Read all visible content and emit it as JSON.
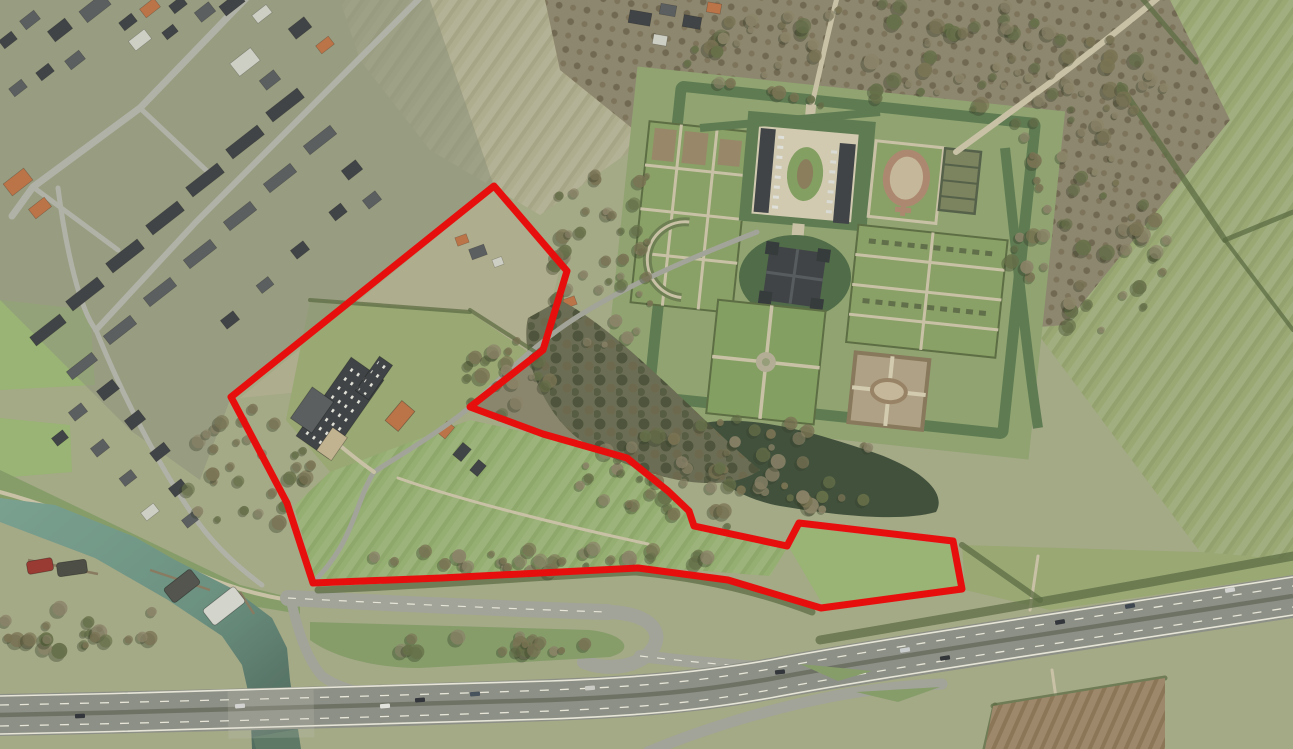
{
  "meta": {
    "description": "Aerial orthophoto with red cadastral parcel boundary overlay",
    "width_px": 1293,
    "height_px": 749
  },
  "palette": {
    "field_base": "#a7ac8a",
    "field_pale": "#b2b091",
    "field_mid": "#9cab77",
    "field_green": "#97b173",
    "field_bright": "#9bb877",
    "dike_green": "#87a06c",
    "town_base": "#90957f",
    "scrub": "#8c8770",
    "park": "#8f8871",
    "street": "#b4b6ac",
    "road": "#a5a79d",
    "path": "#cdc6ab",
    "gravel": "#d6cfb6",
    "highway": "#8f9289",
    "highway_median": "#6e7267",
    "lane_mark": "#edebe0",
    "river_light": "#7ba394",
    "river_deep": "#4b655a",
    "canal": "#5d7a68",
    "moat": "#5e7c53",
    "moat_dark": "#506c48",
    "pond": "#40503c",
    "woods": "#6b6e55",
    "wood_dark": "#3f4c36",
    "tree_a": "#7b7455",
    "tree_b": "#8d856b",
    "tree_c": "#667049",
    "hedge": "#5c6e44",
    "lawn": "#8ba368",
    "garden_lawn": "#84a263",
    "parterre": "#9a8a6b",
    "knot_ring": "#b08a73",
    "plow": "#a08a6d",
    "roof_dark": "#3e4246",
    "roof_slate": "#5a5e61",
    "roof_orange": "#bf7348",
    "roof_light": "#d3d4cb",
    "roof_tan": "#c7b794",
    "parcel_red": "#ee0a0a"
  },
  "landmarks": {
    "town": "residential village north-west",
    "estate": "moated castle estate with formal gardens",
    "river": "river harbour with moored barges",
    "motorway": "motorway with interchange ramps",
    "parcel": "red outlined land parcel"
  },
  "parcel": {
    "name": "highlighted-parcel-boundary",
    "stroke_width": 7,
    "points": "494,186 567,271 543,350 470,407 543,434 627,458 668,491 689,511 694,526 787,546 799,523 953,541 962,589 821,608 728,580 638,568 441,578 313,583 287,503 231,397"
  },
  "roads": [
    {
      "name": "main-street",
      "d": "M250,-6 L140,108 L33,187 L12,216",
      "w": 7,
      "c": "street"
    },
    {
      "name": "back-street",
      "d": "M424,-6 L310,108 L196,222 L96,330",
      "w": 6,
      "c": "street"
    },
    {
      "name": "cross-street-1",
      "d": "M140,108 L208,172",
      "w": 5,
      "c": "street"
    },
    {
      "name": "cross-street-2",
      "d": "M33,187 L118,250",
      "w": 5,
      "c": "street"
    },
    {
      "name": "south-street",
      "d": "M58,188 C66,250 80,310 96,330",
      "w": 5,
      "c": "street"
    },
    {
      "name": "harbour-lane",
      "d": "M96,330 C120,390 160,470 200,525 C215,545 235,565 262,585",
      "w": 5,
      "c": "street"
    },
    {
      "name": "dike-path",
      "d": "M0,492 C60,508 120,535 168,560 C205,578 240,592 288,600",
      "w": 4,
      "c": "path"
    },
    {
      "name": "castle-lane",
      "d": "M757,232 C690,258 610,292 558,330 C520,358 495,384 470,407 C440,432 400,455 374,472 C362,490 356,520 340,548 C330,565 320,575 313,583",
      "w": 5,
      "c": "road"
    },
    {
      "name": "farm-drive",
      "d": "M374,472 C360,462 350,454 338,444",
      "w": 4,
      "c": "path"
    },
    {
      "name": "field-track",
      "d": "M398,478 C460,500 560,525 648,544",
      "w": 3,
      "c": "path"
    },
    {
      "name": "north-avenue-drive",
      "d": "M812,104 C818,80 826,40 838,-6",
      "w": 5,
      "c": "path"
    },
    {
      "name": "ne-tree-lane",
      "d": "M956,152 C1020,105 1090,55 1165,-8",
      "w": 6,
      "c": "path"
    },
    {
      "name": "underpass-track-n",
      "d": "M1038,556 L1030,610",
      "w": 3,
      "c": "path"
    },
    {
      "name": "underpass-track-s",
      "d": "M1052,670 L1060,726",
      "w": 3,
      "c": "path"
    },
    {
      "name": "local-road",
      "d": "M288,598 C400,604 540,610 608,612",
      "w": 16,
      "c": "road"
    },
    {
      "name": "ramp-loop",
      "d": "M608,612 C652,613 666,634 650,652 C635,669 604,670 584,662",
      "w": 14,
      "c": "road"
    },
    {
      "name": "ramp-merge",
      "d": "M640,656 C700,663 750,667 800,670 L872,677",
      "w": 12,
      "c": "road"
    },
    {
      "name": "west-onramp",
      "d": "M291,601 C298,630 306,658 322,676 C340,690 372,697 424,700",
      "w": 10,
      "c": "road"
    },
    {
      "name": "south-ramp",
      "d": "M648,752 C700,730 770,708 840,695 C880,688 912,685 942,684",
      "w": 11,
      "c": "road"
    }
  ],
  "road_marks": [
    {
      "name": "local-road-centerline",
      "d": "M288,598 C400,604 540,610 608,612",
      "w": 1.2,
      "dash": "8 9"
    },
    {
      "name": "ramp-centerline",
      "d": "M640,656 C700,663 750,667 800,670",
      "w": 1.2,
      "dash": "8 9"
    }
  ],
  "hedges": [
    {
      "name": "hedge-ne-1",
      "d": "M1120,85 L1225,240",
      "w": 6
    },
    {
      "name": "hedge-ne-2",
      "d": "M1225,240 L1293,212",
      "w": 5
    },
    {
      "name": "hedge-ne-3",
      "d": "M1140,-4 L1196,62",
      "w": 5
    },
    {
      "name": "hedge-ne-4",
      "d": "M1225,240 L1293,330",
      "w": 4
    },
    {
      "name": "hedge-motorway",
      "d": "M820,640 C950,618 1100,592 1293,556",
      "w": 9
    },
    {
      "name": "hedge-parcel-south",
      "d": "M318,590 C450,585 560,575 636,572 C700,578 760,592 812,612",
      "w": 7
    },
    {
      "name": "hedge-east-field",
      "d": "M962,545 L1040,600",
      "w": 6
    },
    {
      "name": "hedge-plow-top",
      "d": "M993,706 L1165,678",
      "w": 5
    },
    {
      "name": "hedge-plow-left",
      "d": "M995,705 L985,749",
      "w": 5
    },
    {
      "name": "hedge-mid-1",
      "d": "M470,310 L540,355",
      "w": 4
    },
    {
      "name": "hedge-mid-2",
      "d": "M310,300 L470,312",
      "w": 4
    }
  ],
  "houses": [
    [
      95,
      8,
      30,
      14,
      -38,
      "roof_slate"
    ],
    [
      128,
      22,
      16,
      10,
      -38,
      "roof_dark"
    ],
    [
      150,
      8,
      18,
      11,
      -38,
      "roof_orange"
    ],
    [
      178,
      5,
      16,
      10,
      -38,
      "roof_dark"
    ],
    [
      205,
      12,
      18,
      12,
      -38,
      "roof_slate"
    ],
    [
      232,
      4,
      24,
      12,
      -38,
      "roof_dark"
    ],
    [
      262,
      14,
      18,
      10,
      -38,
      "roof_light"
    ],
    [
      300,
      28,
      20,
      13,
      -38,
      "roof_dark"
    ],
    [
      325,
      45,
      16,
      10,
      -38,
      "roof_orange"
    ],
    [
      140,
      40,
      20,
      12,
      -38,
      "roof_light"
    ],
    [
      170,
      32,
      14,
      9,
      -38,
      "roof_dark"
    ],
    [
      245,
      62,
      26,
      16,
      -38,
      "roof_light"
    ],
    [
      270,
      80,
      18,
      12,
      -38,
      "roof_slate"
    ],
    [
      60,
      30,
      22,
      13,
      -38,
      "roof_dark"
    ],
    [
      30,
      20,
      18,
      11,
      -38,
      "roof_slate"
    ],
    [
      8,
      40,
      16,
      10,
      -38,
      "roof_dark"
    ],
    [
      75,
      60,
      18,
      11,
      -38,
      "roof_slate"
    ],
    [
      45,
      72,
      16,
      10,
      -38,
      "roof_dark"
    ],
    [
      18,
      88,
      16,
      10,
      -38,
      "roof_slate"
    ],
    [
      285,
      105,
      40,
      12,
      -38,
      "roof_dark"
    ],
    [
      245,
      142,
      40,
      12,
      -38,
      "roof_dark"
    ],
    [
      205,
      180,
      40,
      12,
      -38,
      "roof_dark"
    ],
    [
      165,
      218,
      40,
      12,
      -38,
      "roof_dark"
    ],
    [
      125,
      256,
      40,
      12,
      -38,
      "roof_dark"
    ],
    [
      85,
      294,
      40,
      12,
      -38,
      "roof_dark"
    ],
    [
      48,
      330,
      38,
      11,
      -38,
      "roof_dark"
    ],
    [
      320,
      140,
      34,
      11,
      -38,
      "roof_slate"
    ],
    [
      280,
      178,
      34,
      11,
      -38,
      "roof_slate"
    ],
    [
      240,
      216,
      34,
      11,
      -38,
      "roof_slate"
    ],
    [
      200,
      254,
      34,
      11,
      -38,
      "roof_slate"
    ],
    [
      160,
      292,
      34,
      11,
      -38,
      "roof_slate"
    ],
    [
      120,
      330,
      34,
      11,
      -38,
      "roof_slate"
    ],
    [
      82,
      366,
      32,
      10,
      -38,
      "roof_slate"
    ],
    [
      352,
      170,
      18,
      12,
      -38,
      "roof_dark"
    ],
    [
      372,
      200,
      16,
      11,
      -38,
      "roof_slate"
    ],
    [
      338,
      212,
      15,
      11,
      -38,
      "roof_dark"
    ],
    [
      300,
      250,
      16,
      11,
      -38,
      "roof_dark"
    ],
    [
      265,
      285,
      15,
      10,
      -38,
      "roof_slate"
    ],
    [
      230,
      320,
      16,
      11,
      -38,
      "roof_dark"
    ],
    [
      18,
      182,
      26,
      15,
      -38,
      "roof_orange"
    ],
    [
      40,
      208,
      20,
      12,
      -38,
      "roof_orange"
    ],
    [
      108,
      390,
      20,
      12,
      -38,
      "roof_dark"
    ],
    [
      78,
      412,
      16,
      11,
      -38,
      "roof_slate"
    ],
    [
      135,
      420,
      18,
      12,
      -38,
      "roof_dark"
    ],
    [
      100,
      448,
      16,
      11,
      -38,
      "roof_slate"
    ],
    [
      160,
      452,
      18,
      11,
      -38,
      "roof_dark"
    ],
    [
      128,
      478,
      15,
      10,
      -38,
      "roof_slate"
    ],
    [
      178,
      488,
      16,
      11,
      -38,
      "roof_dark"
    ],
    [
      60,
      438,
      14,
      10,
      -38,
      "roof_dark"
    ],
    [
      150,
      512,
      16,
      10,
      -38,
      "roof_light"
    ],
    [
      190,
      520,
      14,
      10,
      -38,
      "roof_slate"
    ],
    [
      478,
      252,
      16,
      11,
      -20,
      "roof_slate"
    ],
    [
      462,
      240,
      12,
      9,
      -20,
      "roof_orange"
    ],
    [
      498,
      262,
      10,
      8,
      -20,
      "roof_light"
    ],
    [
      560,
      322,
      18,
      12,
      -20,
      "roof_dark"
    ],
    [
      582,
      342,
      15,
      10,
      -20,
      "roof_dark"
    ],
    [
      570,
      302,
      12,
      9,
      -20,
      "roof_orange"
    ],
    [
      600,
      355,
      13,
      9,
      -20,
      "roof_slate"
    ],
    [
      446,
      430,
      15,
      10,
      -50,
      "roof_orange"
    ],
    [
      462,
      452,
      16,
      11,
      -50,
      "roof_dark"
    ],
    [
      478,
      468,
      14,
      10,
      -50,
      "roof_dark"
    ],
    [
      1030,
      170,
      16,
      11,
      35,
      "roof_dark"
    ],
    [
      1046,
      185,
      13,
      9,
      35,
      "roof_slate"
    ],
    [
      1035,
      198,
      12,
      9,
      35,
      "roof_dark"
    ],
    [
      640,
      18,
      22,
      13,
      10,
      "roof_dark"
    ],
    [
      668,
      10,
      16,
      11,
      10,
      "roof_slate"
    ],
    [
      692,
      22,
      18,
      12,
      10,
      "roof_dark"
    ],
    [
      714,
      8,
      14,
      10,
      10,
      "roof_orange"
    ],
    [
      660,
      40,
      14,
      10,
      10,
      "roof_light"
    ]
  ],
  "farm_buildings": [
    {
      "name": "barn-skylight-roof",
      "x": 340,
      "y": 408,
      "w": 96,
      "h": 40,
      "rot": -55,
      "c": "roof_dark",
      "skylights": true
    },
    {
      "name": "gable-house",
      "x": 312,
      "y": 410,
      "w": 38,
      "h": 26,
      "rot": -55,
      "c": "roof_slate",
      "skylights": false
    },
    {
      "name": "tan-shed",
      "x": 332,
      "y": 444,
      "w": 28,
      "h": 18,
      "rot": -55,
      "c": "roof_tan",
      "skylights": false
    },
    {
      "name": "north-wing",
      "x": 374,
      "y": 378,
      "w": 42,
      "h": 16,
      "rot": -55,
      "c": "roof_dark",
      "skylights": true
    },
    {
      "name": "farmhouse-orange",
      "x": 400,
      "y": 416,
      "w": 26,
      "h": 17,
      "rot": -50,
      "c": "roof_orange",
      "skylights": false
    }
  ],
  "boats": [
    {
      "name": "red-barge",
      "x": 40,
      "y": 566,
      "w": 26,
      "h": 13,
      "rot": -10,
      "c": "#9c3832"
    },
    {
      "name": "dark-barge-1",
      "x": 72,
      "y": 568,
      "w": 30,
      "h": 14,
      "rot": -8,
      "c": "#4b4c46"
    },
    {
      "name": "dark-barge-2",
      "x": 182,
      "y": 586,
      "w": 34,
      "h": 18,
      "rot": -38,
      "c": "#53544e"
    },
    {
      "name": "white-barge",
      "x": 224,
      "y": 606,
      "w": 40,
      "h": 20,
      "rot": -38,
      "c": "#d9dad2"
    }
  ],
  "piers": [
    {
      "name": "pier-1",
      "d": "M28,560 L98,574",
      "w": 2.5
    },
    {
      "name": "pier-2",
      "d": "M150,570 L210,590",
      "w": 2.5
    },
    {
      "name": "pier-3",
      "d": "M240,592 L254,614",
      "w": 2.5
    }
  ],
  "vehicles": [
    [
      80,
      716,
      -3,
      "#30343a"
    ],
    [
      240,
      706,
      -4,
      "#d8d8d8"
    ],
    [
      420,
      700,
      -4,
      "#30343a"
    ],
    [
      475,
      694,
      -4,
      "#45525e"
    ],
    [
      590,
      688,
      -5,
      "#d0d0cc"
    ],
    [
      780,
      672,
      -7,
      "#30343a"
    ],
    [
      905,
      650,
      -9,
      "#cfd2d4"
    ],
    [
      1060,
      622,
      -10,
      "#30343a"
    ],
    [
      1130,
      606,
      -10,
      "#3c4450"
    ],
    [
      1230,
      590,
      -10,
      "#d8d8d8"
    ],
    [
      945,
      658,
      -9,
      "#2f3338"
    ],
    [
      385,
      706,
      -4,
      "#e9e9e6"
    ]
  ],
  "tree_clusters": [
    {
      "name": "woodland-south-of-parcel",
      "cx": 730,
      "cy": 472,
      "rx": 155,
      "ry": 55,
      "n": 64,
      "seed": 11
    },
    {
      "name": "park-strip-west-of-gardens",
      "cx": 605,
      "cy": 250,
      "rx": 55,
      "ry": 115,
      "n": 42,
      "seed": 22
    },
    {
      "name": "park-north-avenues",
      "cx": 900,
      "cy": 55,
      "rx": 225,
      "ry": 55,
      "n": 66,
      "seed": 33
    },
    {
      "name": "park-east",
      "cx": 1085,
      "cy": 235,
      "rx": 90,
      "ry": 115,
      "n": 48,
      "seed": 44
    },
    {
      "name": "scrub-west-of-parcel",
      "cx": 250,
      "cy": 470,
      "rx": 70,
      "ry": 62,
      "n": 30,
      "seed": 55
    },
    {
      "name": "river-bank-shrubs",
      "cx": 85,
      "cy": 632,
      "rx": 110,
      "ry": 26,
      "n": 24,
      "seed": 66
    },
    {
      "name": "parcel-south-hedgerow",
      "cx": 560,
      "cy": 560,
      "rx": 215,
      "ry": 12,
      "n": 30,
      "seed": 77
    },
    {
      "name": "interchange-island-bushes",
      "cx": 470,
      "cy": 644,
      "rx": 115,
      "ry": 11,
      "n": 18,
      "seed": 88
    },
    {
      "name": "notch-scrub",
      "cx": 505,
      "cy": 378,
      "rx": 45,
      "ry": 40,
      "n": 22,
      "seed": 99
    },
    {
      "name": "ne-lane-trees",
      "cx": 1060,
      "cy": 75,
      "rx": 110,
      "ry": 70,
      "n": 30,
      "seed": 12
    }
  ]
}
